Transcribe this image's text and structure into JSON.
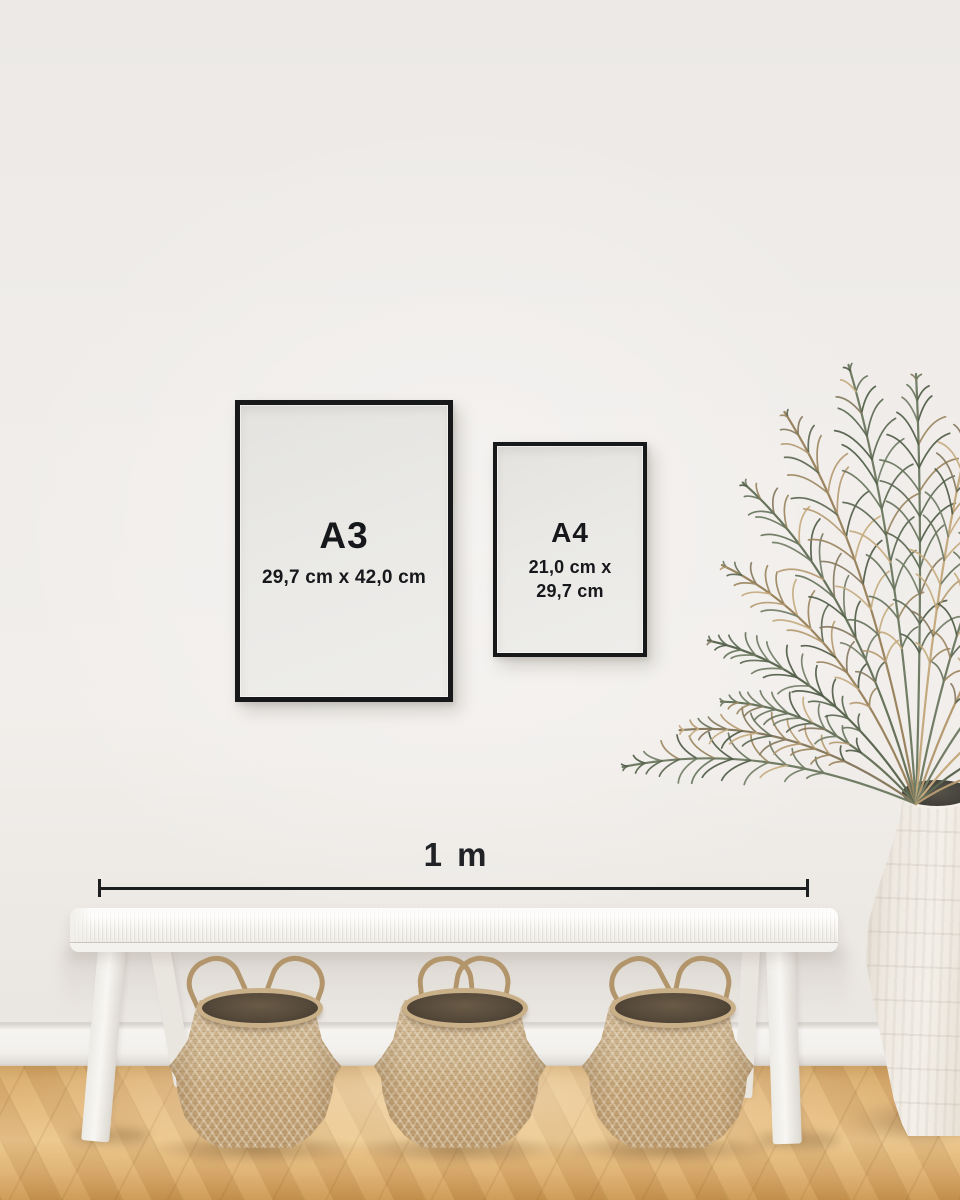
{
  "frames": [
    {
      "label": "A3",
      "dimensions": "29,7 cm x 42,0 cm"
    },
    {
      "label": "A4",
      "dimensions_line1": "21,0 cm x",
      "dimensions_line2": "29,7 cm"
    }
  ],
  "scale": {
    "label": "1 m"
  },
  "palette": {
    "frame_border": "#17181a",
    "poster_paper": "#e9e8e5",
    "label_text": "#17181b",
    "scale_line": "#1d1e20",
    "wall": "#f0edea",
    "baseboard": "#f5f3f0",
    "floor_mid": "#ddae6f",
    "bench_white": "#f5f3ef",
    "basket_tan": "#c6ab81",
    "basket_dark": "#54483a",
    "vase_cream": "#efebe3",
    "plant_green": "#5e6a54",
    "plant_dry": "#b59a71"
  }
}
